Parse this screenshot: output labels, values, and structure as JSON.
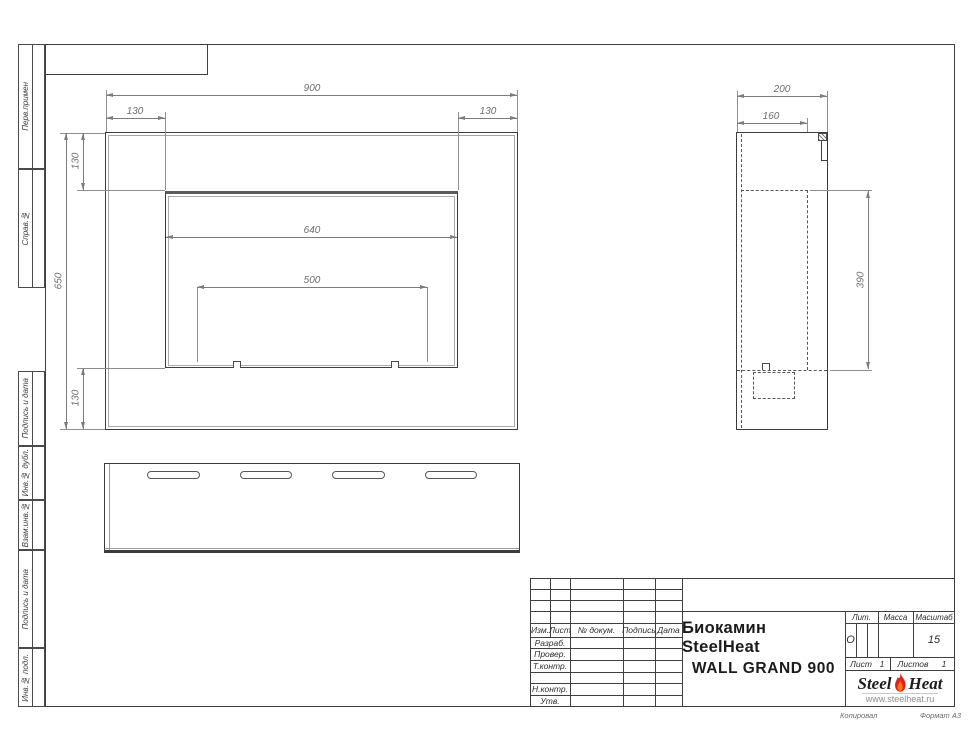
{
  "left_column_labels": [
    "Перв.примен",
    "Справ.№",
    "Подпись и дата",
    "Инв.№ дубл.",
    "Взам.инв.№",
    "Подпись и дата",
    "Инв.№ подл."
  ],
  "front_view": {
    "total_width": "900",
    "margin_left": "130",
    "margin_right": "130",
    "total_height": "650",
    "margin_top": "130",
    "margin_bottom": "130",
    "opening_width": "640",
    "burner_width": "500"
  },
  "side_view": {
    "total_depth": "200",
    "inner_depth": "160",
    "opening_height": "390"
  },
  "title_block": {
    "header_cols": [
      "Изм.",
      "Лист",
      "№ докум.",
      "Подпись",
      "Дата"
    ],
    "rows": [
      "Разраб.",
      "Провер.",
      "Т.контр.",
      "",
      "Н.контр.",
      "Утв."
    ],
    "title_line1": "Биокамин SteelHeat",
    "title_line2": "WALL GRAND 900",
    "lit_label": "Лит.",
    "lit_value": "О",
    "massa_label": "Масса",
    "scale_label": "Масштаб",
    "scale_value": "15",
    "sheet_label": "Лист",
    "sheet_value": "1",
    "sheets_label": "Листов",
    "sheets_value": "1",
    "logo_steel": "Steel",
    "logo_heat": "Heat",
    "logo_url": "www.steelheat.ru"
  },
  "footer": {
    "copy_note": "Копировал",
    "format_note": "Формат А3"
  },
  "colors": {
    "line": "#3f3f3f",
    "dim": "#7c7c7c",
    "flame_red": "#e2231a",
    "flame_orange": "#f07818"
  }
}
